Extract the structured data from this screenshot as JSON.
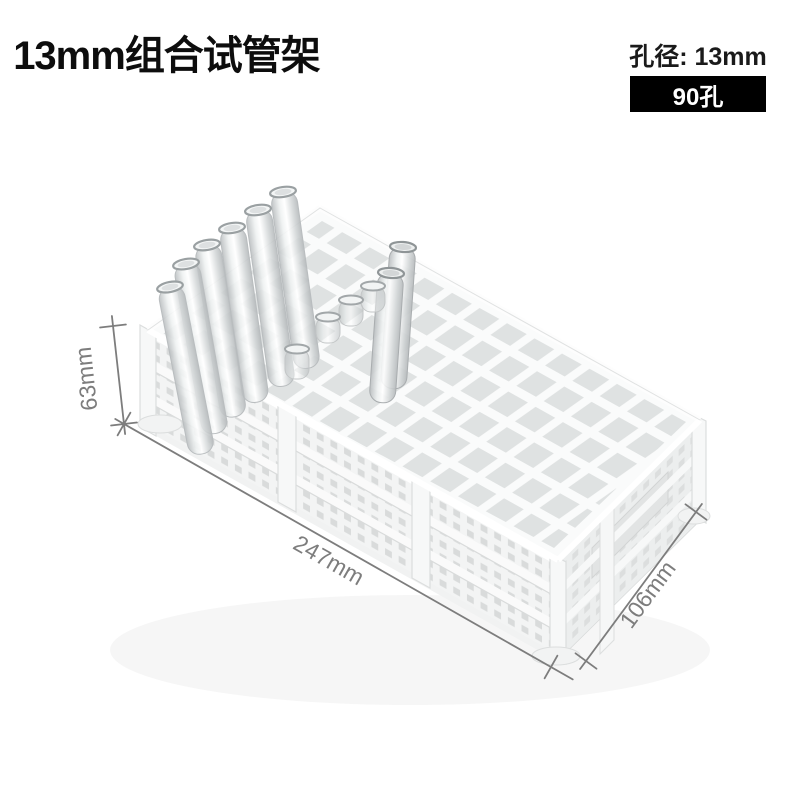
{
  "page": {
    "background": "#ffffff",
    "description_of_photo": "white plastic combined test tube rack, 3 stacked tiers, with clear glass test tubes inserted along back-left row"
  },
  "header": {
    "title": "13mm组合试管架"
  },
  "spec": {
    "diameter_label": "孔径: 13mm",
    "holes_label": "90孔"
  },
  "annotations": {
    "height": "63mm",
    "length": "247mm",
    "depth": "106mm"
  },
  "colors": {
    "title_fg": "#0d0d0d",
    "badge_bg": "#000000",
    "badge_fg": "#ffffff",
    "dimension_gray": "#7d7d7d",
    "rack_white": "#f7f7f7",
    "rack_shade": "#dfe2e2",
    "glass_edge": "#b9bdbf"
  }
}
